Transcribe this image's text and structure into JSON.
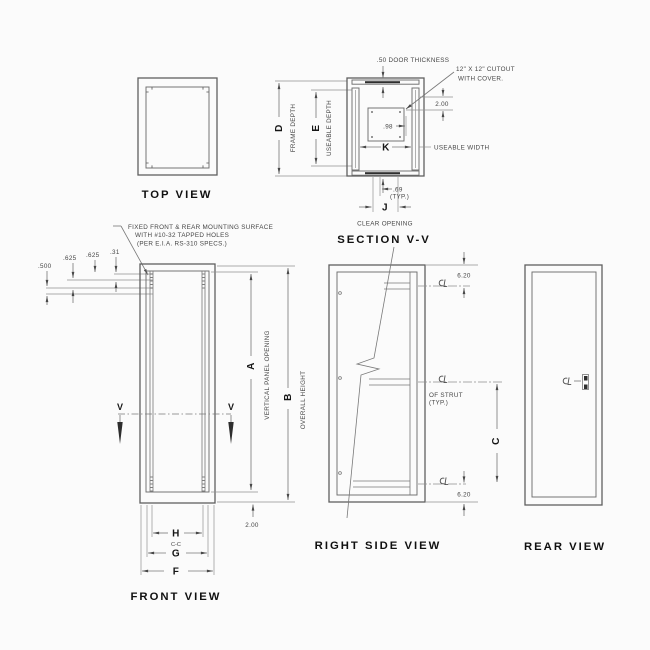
{
  "views": {
    "top": {
      "title": "TOP VIEW"
    },
    "depth": {
      "d": "D",
      "frame_depth": "FRAME DEPTH",
      "e": "E",
      "useable_depth": "USEABLE DEPTH"
    },
    "section": {
      "title": "SECTION V-V",
      "door_thickness": ".50 DOOR THICKNESS",
      "cutout_line1": "12\" X 12\" CUTOUT",
      "cutout_line2": "WITH COVER.",
      "dim_offset": "2.00",
      "dim_hole": ".98",
      "k": "K",
      "useable_width": "USEABLE WIDTH",
      "dim_flange": ".69",
      "typ": "(TYP.)",
      "j": "J",
      "clear_opening": "CLEAR OPENING"
    },
    "front": {
      "title": "FRONT VIEW",
      "note1": "FIXED FRONT & REAR MOUNTING SURFACE",
      "note2": "WITH #10-32 TAPPED HOLES",
      "note3": "(PER E.I.A. RS-310 SPECS.)",
      "offsets": [
        ".500",
        ".625",
        ".625",
        ".31"
      ],
      "v": "V",
      "a": "A",
      "a_label": "VERTICAL PANEL OPENING",
      "b": "B",
      "b_label": "OVERALL HEIGHT",
      "dim_bottom": "2.00",
      "h": "H",
      "cc": "C-C",
      "g": "G",
      "f": "F"
    },
    "right": {
      "title": "RIGHT SIDE VIEW",
      "dim_top": "6.20",
      "dim_bottom": "6.20",
      "c": "C",
      "strut_label1": "OF STRUT",
      "strut_label2": "(TYP.)"
    },
    "rear": {
      "title": "REAR VIEW"
    }
  },
  "colors": {
    "background": "#fbfbfb",
    "line": "#6e6e6e",
    "dim_text": "#454545",
    "bold_text": "#161616"
  }
}
